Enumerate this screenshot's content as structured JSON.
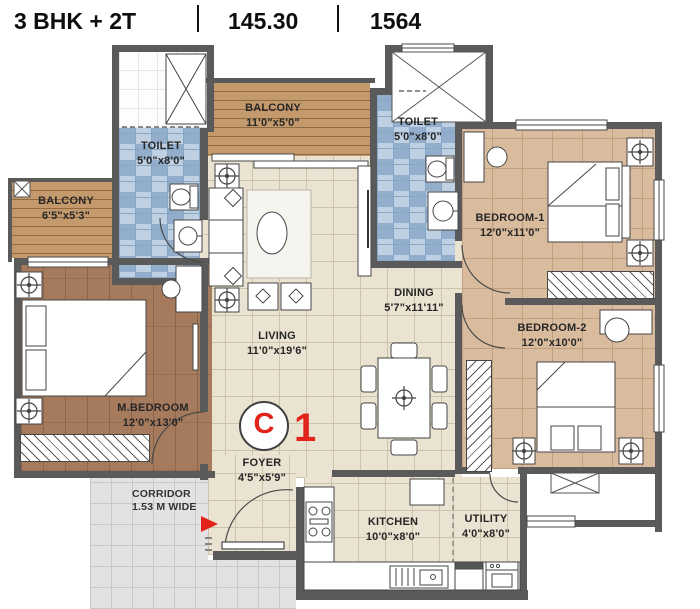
{
  "header": {
    "unit_type": "3 BHK + 2T",
    "area_sqm": "145.30",
    "area_sqft": "1564"
  },
  "marker": {
    "letter": "C",
    "number": "1"
  },
  "rooms": {
    "balcony_top": {
      "name": "BALCONY",
      "dims": "11'0\"x5'0\""
    },
    "toilet_left": {
      "name": "TOILET",
      "dims": "5'0\"x8'0\""
    },
    "toilet_right": {
      "name": "TOILET",
      "dims": "5'0\"x8'0\""
    },
    "balcony_left": {
      "name": "BALCONY",
      "dims": "6'5\"x5'3\""
    },
    "bedroom_1": {
      "name": "BEDROOM-1",
      "dims": "12'0\"x11'0\""
    },
    "dining": {
      "name": "DINING",
      "dims": "5'7\"x11'11\""
    },
    "living": {
      "name": "LIVING",
      "dims": "11'0\"x19'6\""
    },
    "bedroom_2": {
      "name": "BEDROOM-2",
      "dims": "12'0\"x10'0\""
    },
    "m_bedroom": {
      "name": "M.BEDROOM",
      "dims": "12'0\"x13'0\""
    },
    "foyer": {
      "name": "FOYER",
      "dims": "4'5\"x5'9\""
    },
    "corridor": {
      "name": "CORRIDOR",
      "dims": "1.53 M WIDE"
    },
    "kitchen": {
      "name": "KITCHEN",
      "dims": "10'0\"x8'0\""
    },
    "utility": {
      "name": "UTILITY",
      "dims": "4'0\"x8'0\""
    }
  },
  "colors": {
    "wall": "#5a5a5a",
    "accent_red": "#e2231a",
    "floor_tile": "#ebe3d2",
    "floor_bedroom": "#d9bc9e",
    "floor_master": "#a67a5c",
    "floor_balcony": "#c49a6d",
    "floor_toilet": "#a9c0d8",
    "floor_corridor": "#e2e2e2"
  }
}
